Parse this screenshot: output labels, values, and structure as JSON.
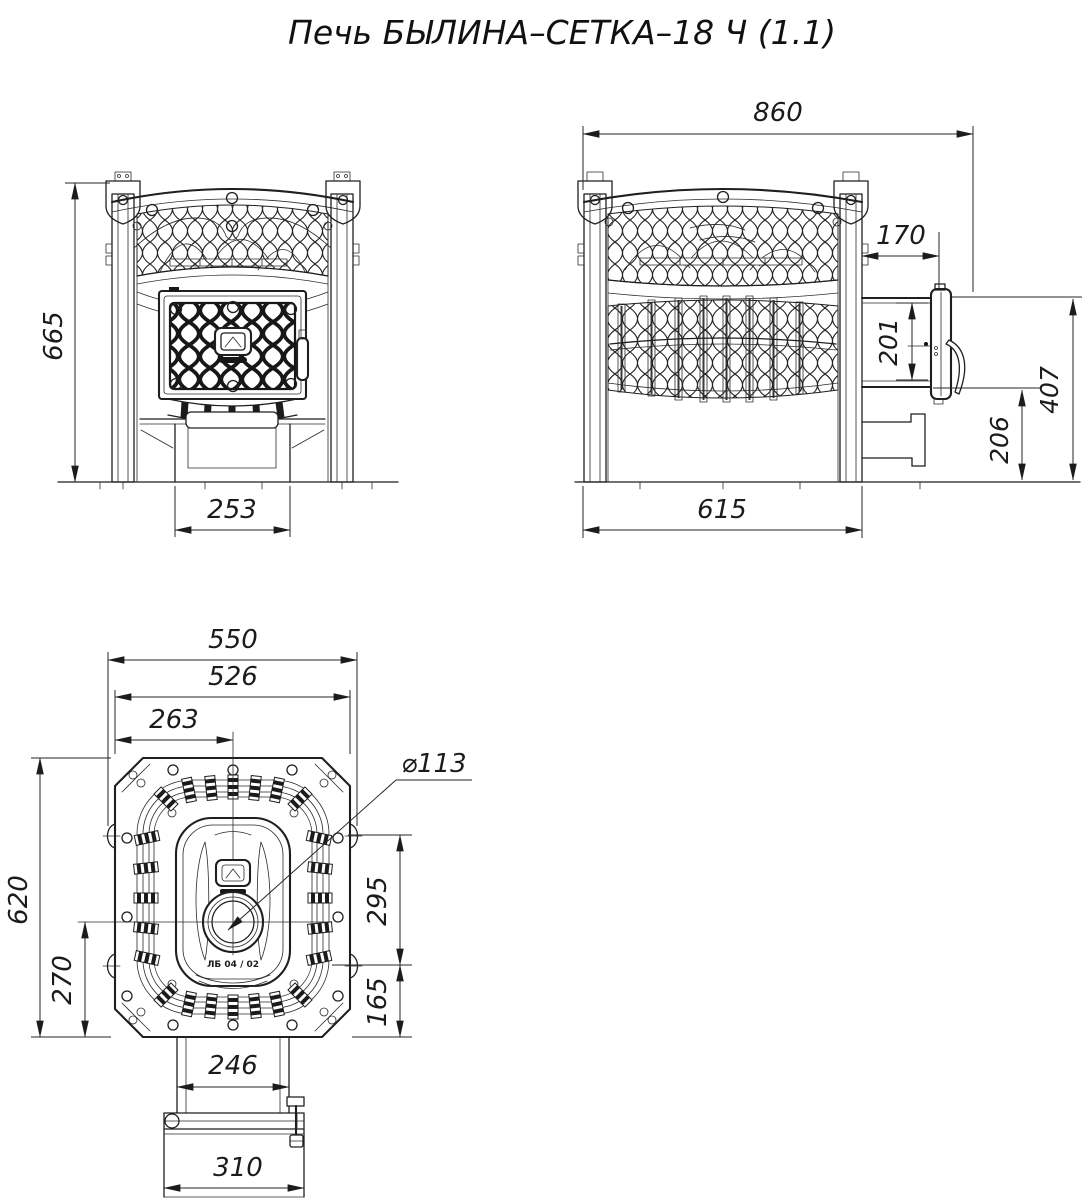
{
  "title": "Печь БЫЛИНА–СЕТКА–18 Ч (1.1)",
  "views": {
    "front": {
      "dim_height": "665",
      "dim_base_width": "253"
    },
    "side": {
      "dim_overall_length": "860",
      "dim_body_length": "615",
      "dim_tunnel_length": "170",
      "dim_tunnel_door_height": "201",
      "dim_tunnel_bottom_height": "206",
      "dim_tunnel_top_height": "407"
    },
    "top": {
      "dim_overall_width": "550",
      "dim_flange_width": "526",
      "dim_chimney_offset": "263",
      "chimney_diameter": "⌀113",
      "dim_depth": "620",
      "dim_chimney_to_rear": "270",
      "dim_mid_section": "295",
      "dim_rear_section": "165",
      "dim_tunnel_width": "246",
      "dim_door_width": "310",
      "door_marking": "ЛБ 04 / 02"
    }
  }
}
